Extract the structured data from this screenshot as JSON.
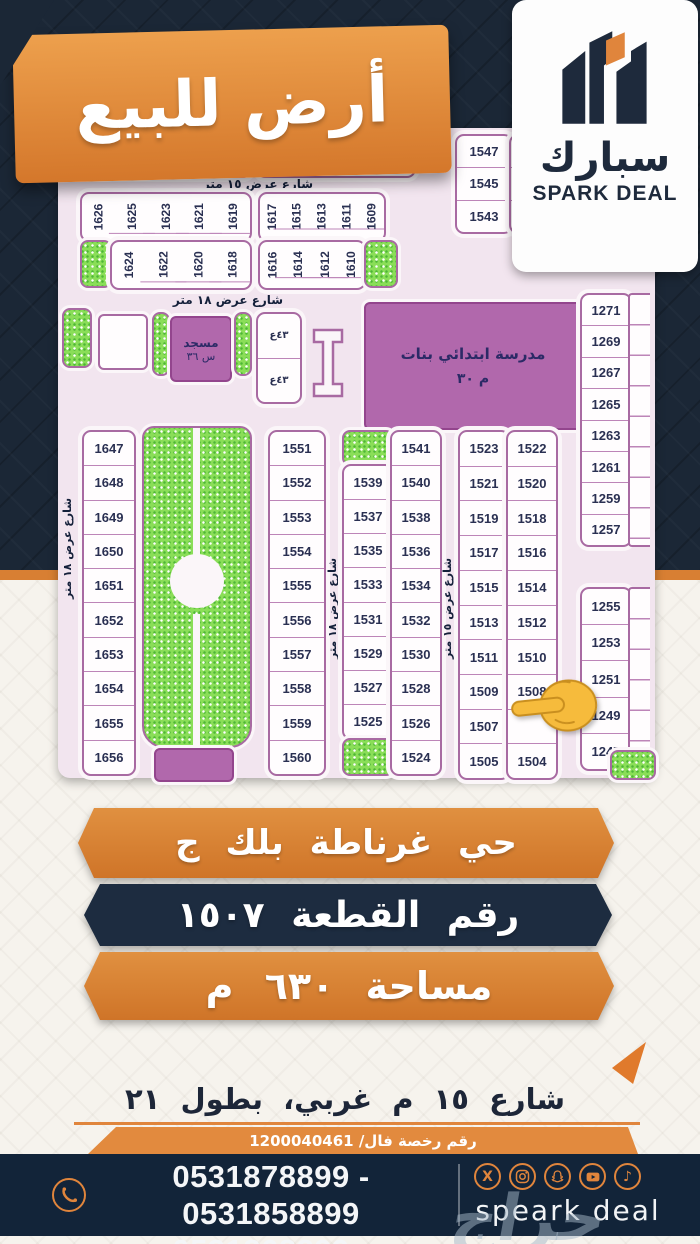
{
  "title_banner": {
    "text": "أرض للبيع"
  },
  "logo": {
    "arabic": "سبارك",
    "english": "SPARK DEAL"
  },
  "map": {
    "street_15m": "شارع عرض ١٥ متر",
    "street_18m": "شارع عرض ١٨ متر",
    "row_top": [
      "162",
      "162",
      "163",
      "163",
      "163",
      "163",
      "163",
      "164",
      "164",
      "164"
    ],
    "row2_top_left": [
      "1626",
      "1625",
      "1623",
      "1621",
      "1619"
    ],
    "row2_top_right": [
      "1617",
      "1615",
      "1613",
      "1611",
      "1609"
    ],
    "row2_bottom_left": [
      "1624",
      "1622",
      "1620",
      "1618"
    ],
    "row2_bottom_right": [
      "1616",
      "1614",
      "1612",
      "1610"
    ],
    "block_1547": [
      "1547",
      "1545",
      "1543"
    ],
    "block_1547_partial": [
      "15",
      "15",
      "15"
    ],
    "mosque_line1": "مسجد",
    "mosque_line2": "س ٣٦",
    "school_line1": "مدرسة ابتدائي بنات",
    "school_line2": "م ٣٠",
    "utility_marks": [
      "٤٣ع",
      "٤٣ع"
    ],
    "col_right_a": [
      "1271",
      "1269",
      "1267",
      "1265",
      "1263",
      "1261",
      "1259",
      "1257"
    ],
    "col_right_b": [
      "1255",
      "1253",
      "1251",
      "1249",
      "1247"
    ],
    "col_1647": [
      "1647",
      "1648",
      "1649",
      "1650",
      "1651",
      "1652",
      "1653",
      "1654",
      "1655",
      "1656"
    ],
    "col_1551": [
      "1551",
      "1552",
      "1553",
      "1554",
      "1555",
      "1556",
      "1557",
      "1558",
      "1559",
      "1560"
    ],
    "col_1539": [
      "1539",
      "1537",
      "1535",
      "1533",
      "1531",
      "1529",
      "1527",
      "1525"
    ],
    "col_1541": [
      "1541",
      "1540",
      "1538",
      "1536",
      "1534",
      "1532",
      "1530",
      "1528",
      "1526",
      "1524"
    ],
    "col_1523": [
      "1523",
      "1521",
      "1519",
      "1517",
      "1515",
      "1513",
      "1511",
      "1509",
      "1507",
      "1505"
    ],
    "col_1522": [
      "1522",
      "1520",
      "1518",
      "1516",
      "1514",
      "1512",
      "1510",
      "1508",
      "",
      "1504"
    ]
  },
  "banners": {
    "district": "حي غرناطة بلك ج",
    "plot": "رقم القطعة ١٥٠٧",
    "area": "مساحة ٦٣٠ م"
  },
  "street_note": {
    "text": "شارع ١٥ م غربي، بطول ٢١"
  },
  "license": {
    "text": "رقم رخصة فال/ 1200040461"
  },
  "footer": {
    "phone_line1": "0531878899 - 0531858899",
    "phone_line2": "0531868899 - 0531848899",
    "brand": "speark deal",
    "x_label": "X",
    "tiktok_label": "♪"
  },
  "watermark": "حراج",
  "colors": {
    "accent_orange": "#e0853c",
    "navy": "#1b2736",
    "map_purple": "#b168ac",
    "park_green": "#8ade58"
  }
}
